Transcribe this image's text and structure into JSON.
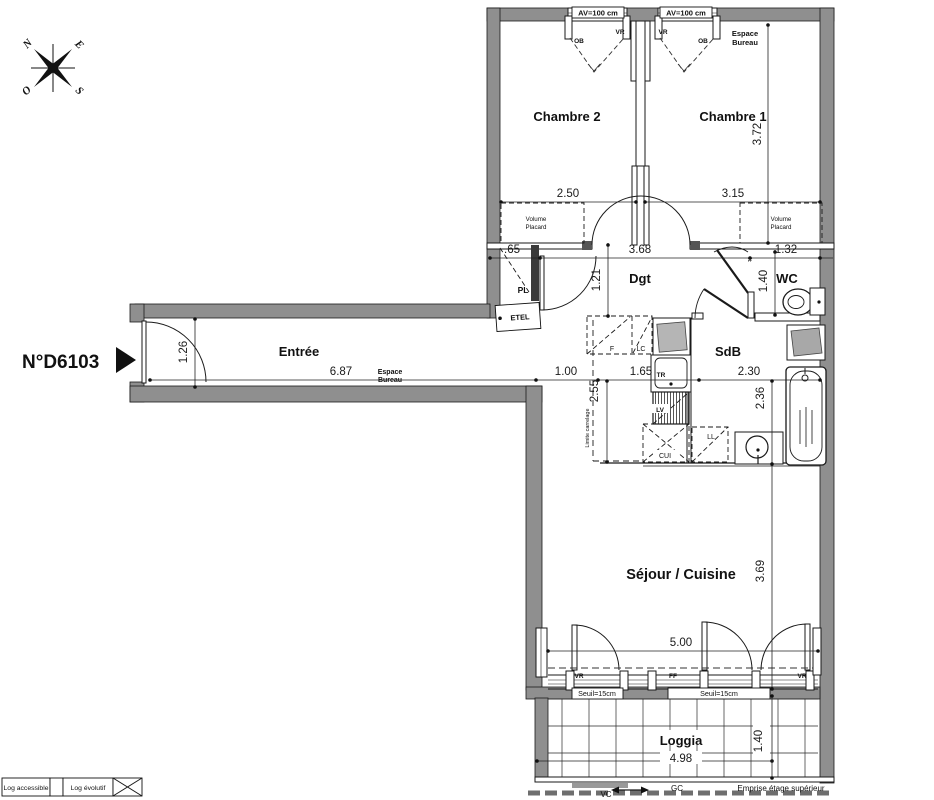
{
  "header": {
    "unit_number": "N°D6103"
  },
  "compass": {
    "n": "N",
    "e": "E",
    "s": "S",
    "o": "O"
  },
  "rooms": {
    "chambre2": "Chambre 2",
    "chambre1": "Chambre 1",
    "dgt": "Dgt",
    "wc": "WC",
    "entree": "Entrée",
    "sdb": "SdB",
    "sejour_cuisine": "Séjour / Cuisine",
    "loggia": "Loggia"
  },
  "dims": {
    "w_chambre2": "2.50",
    "w_chambre1": "3.15",
    "h_chambre1": "3.72",
    "w_placard": ".65",
    "w_dgt": "3.68",
    "w_wc": "1.32",
    "h_dgt": "1.21",
    "h_wc": "1.40",
    "h_entree": "1.26",
    "w_entree": "6.87",
    "w_espace": "1.00",
    "w_cuisine": "1.65",
    "w_sdb": "2.30",
    "h_cuisine": "2.55",
    "h_sdb": "2.36",
    "h_sejour": "3.69",
    "w_sejour": "5.00",
    "w_loggia": "4.98",
    "h_loggia": "1.40"
  },
  "labels": {
    "av": "AV=100 cm",
    "vr": "VR",
    "ob": "OB",
    "ff": "FF",
    "espace": "Espace",
    "bureau": "Bureau",
    "volume": "Volume",
    "placard": "Placard",
    "pl": "PL",
    "etel": "ETEL",
    "f": "F",
    "lc": "LC",
    "tr": "TR",
    "lv": "LV",
    "cui": "CUI",
    "ll": "LL",
    "seuil": "Seuil=15cm",
    "vc": "VC",
    "gc": "GC",
    "emprise": "Emprise étage supérieur",
    "limite_carrelage": "Limite carrelage",
    "hash": "#"
  },
  "legend": {
    "accessible": "Log accessible",
    "evolutif": "Log évolutif"
  },
  "colors": {
    "wall": "#8f8f8f",
    "line": "#1a1a1a",
    "background": "#ffffff"
  }
}
